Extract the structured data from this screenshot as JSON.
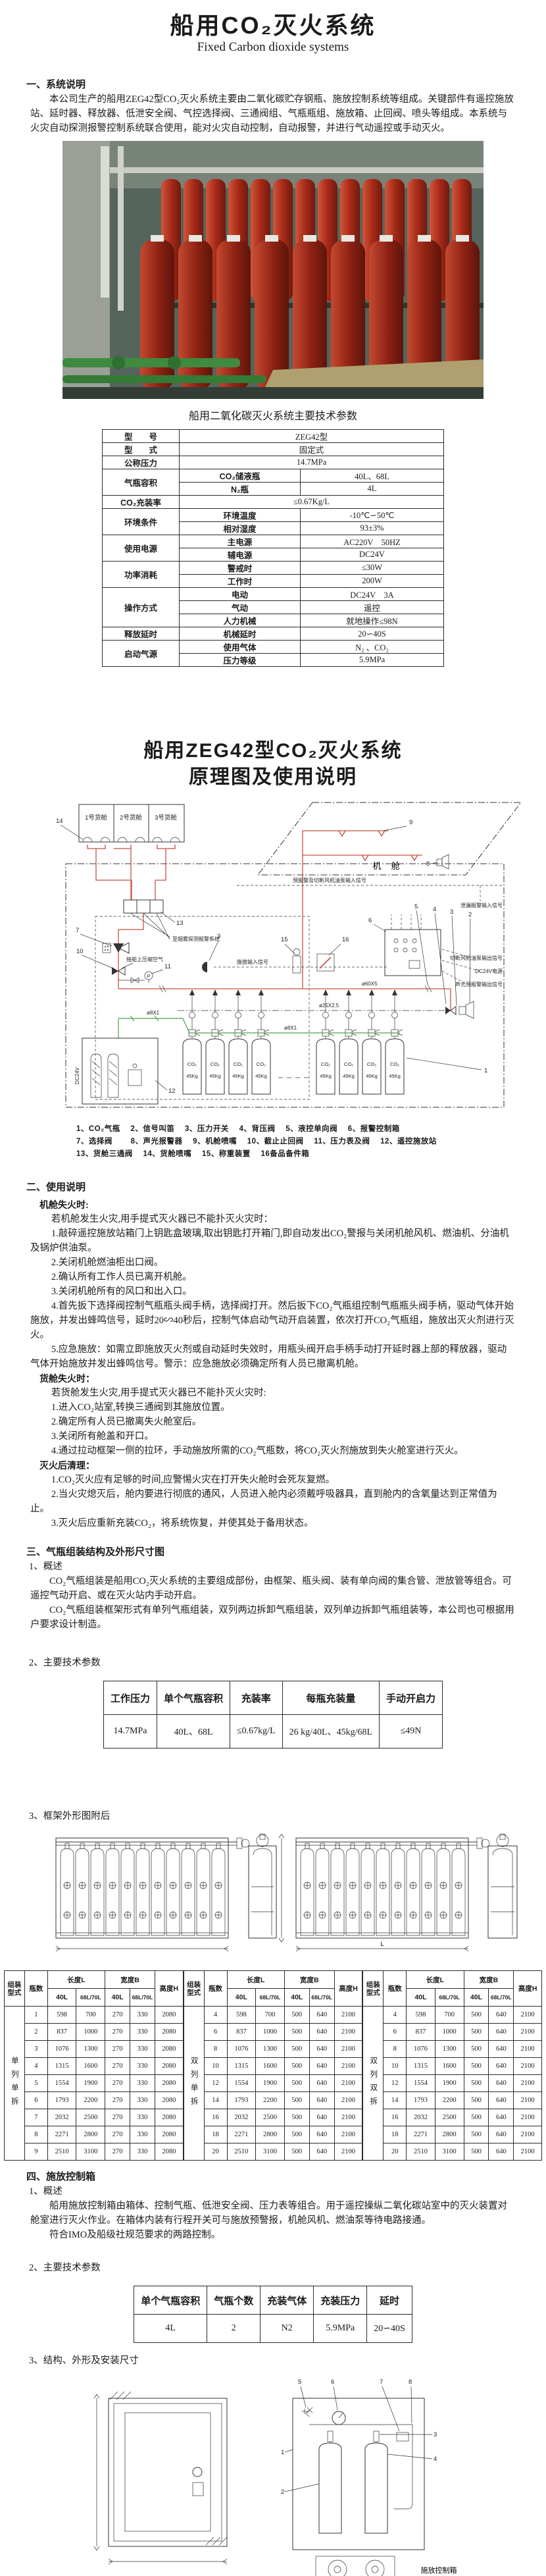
{
  "doc": {
    "title": "船用CO₂灭火系统",
    "subtitle": "Fixed Carbon dioxide systems"
  },
  "colors": {
    "diagram_red": "#c45242",
    "diagram_green": "#4f9e4f",
    "photo_red": "#b5301f"
  },
  "s1": {
    "h": "一、系统说明",
    "p": "本公司生产的船用ZEG42型CO₂灭火系统主要由二氧化碳贮存钢瓶、施放控制系统等组成。关键部件有遥控施放站、延时器、释放器、低泄安全阀、气控选择阀、三通阀组、气瓶瓶组、施放箱、止回阀、喷头等组成。本系统与火灾自动探测报警控制系统联合使用，能对火灾自动控制，自动报警，并进行气动遥控或手动灭火。"
  },
  "spec": {
    "caption": "船用二氧化碳灭火系统主要技术参数",
    "model_l": "型　　号",
    "model_v": "ZEG42型",
    "type_l": "型　　式",
    "type_v": "固定式",
    "press_l": "公称压力",
    "press_v": "14.7MPa",
    "vol_l": "气瓶容积",
    "vol_s1": "CO₂储液瓶",
    "vol_v1": "40L、68L",
    "vol_s2": "N₂瓶",
    "vol_v2": "4L",
    "fill_l": "CO₂充装率",
    "fill_v": "≤0.67Kg/L",
    "env_l": "环境条件",
    "env_s1": "环境温度",
    "env_v1": "-10℃∽50℃",
    "env_s2": "相对湿度",
    "env_v2": "93±3%",
    "pow_l": "使用电源",
    "pow_s1": "主电源",
    "pow_v1": "AC220V　50HZ",
    "pow_s2": "辅电源",
    "pow_v2": "DC24V",
    "cons_l": "功率消耗",
    "cons_s1": "警戒时",
    "cons_v1": "≤30W",
    "cons_s2": "工作时",
    "cons_v2": "200W",
    "op_l": "操作方式",
    "op_s1": "电动",
    "op_v1": "DC24V　3A",
    "op_s2": "气动",
    "op_v2": "遥控",
    "op_s3": "人力机械",
    "op_v3": "就地操作≤98N",
    "delay_l": "释放延时",
    "delay_s": "机械延时",
    "delay_v": "20∽40S",
    "gas_l": "启动气源",
    "gas_s1": "使用气体",
    "gas_v1": "N₂ 、CO₂",
    "gas_s2": "压力等级",
    "gas_v2": "5.9MPa"
  },
  "t2": {
    "l1": "船用ZEG42型CO₂灭火系统",
    "l2": "原理图及使用说明"
  },
  "dia": {
    "hold1": "1号货舱",
    "hold2": "2号货舱",
    "hold3": "3号货舱",
    "engine": "机 舱",
    "c1": "1",
    "c2": "2",
    "c3": "3",
    "c4": "4",
    "c5": "5",
    "c6": "6",
    "c7": "7",
    "c8": "8",
    "c9": "9",
    "c10": "10",
    "c11": "11",
    "c12": "12",
    "c13": "13",
    "c14": "14",
    "c15": "15",
    "c16": "16",
    "sig_pre": "预报警及切断风机油泵输入信号",
    "sig_rel": "施放输入信号",
    "sig_cut": "切断风机油泵输出信号",
    "sig_dc": "DC24V电源",
    "sig_av": "声光预报警输出信号",
    "sig_leak": "泄漏报警输入信号",
    "smoke": "至烟雾探测报警系统",
    "air": "接船上压缩空气",
    "p60": "ø60X5",
    "p25": "ø25X2.5",
    "p8a": "ø8X1",
    "p8b": "ø8X1",
    "dc": "DC24V",
    "cyl_t": "CO₂",
    "cyl_w": "45Kg",
    "p": "P"
  },
  "leg": {
    "l1": "1、CO₂气瓶　 2、信号叫笛　 3、压力开关　 4、背压阀　 5、液控单向阀　 6、报警控制箱",
    "l2": "7、选择阀　　 8、声光报警器　 9、机舱喷嘴　 10、截止止回阀　 11、压力表及阀　 12、遥控施放站",
    "l3": "13、货舱三通阀　 14、货舱喷嘴　 15、称重装置　 16备品备件箱"
  },
  "s2": {
    "h": "二、使用说明",
    "paras": [
      {
        "t": "机舱失火时:"
      },
      {
        "t": "若机舱发生火灾,用手提式灭火器已不能扑灭火灾时："
      },
      {
        "t": "1.敲碎遥控施放站箱门上钥匙盒玻璃,取出钥匙打开箱门,即自动发出CO₂警报与关闭机舱风机、燃油机、分油机及锅炉供油泵。"
      },
      {
        "t": "2.关闭机舱燃油柜出口阀。"
      },
      {
        "t": "2.确认所有工作人员已离开机舱。"
      },
      {
        "t": "3.关闭机舱所有的风口和出入口。"
      },
      {
        "t": "4.首先扳下选择阀控制气瓶瓶头阀手柄，选择阀打开。然后扳下CO₂气瓶组控制气瓶瓶头阀手柄，驱动气体开始施放，并发出蜂鸣信号，延时20∽40秒后，控制气体启动气动开启装置，依次打开CO₂气瓶组，施放出灭火剂进行灭火。"
      },
      {
        "t": "5.应急施放：如需立即施放灭火剂或自动延时失效时，用瓶头阀开启手柄手动打开延时器上部的释放器，驱动气体开始施放并发出蜂鸣信号。警示：应急施放必须确定所有人员已撤离机舱。"
      },
      {
        "t": "货舱失火时："
      },
      {
        "t": "若货舱发生火灾,用手提式灭火器已不能扑灭火灾时:"
      },
      {
        "t": "1.进入CO₂站室,转换三通阀到其施放位置。"
      },
      {
        "t": "2.确定所有人员已撤离失火舱室后。"
      },
      {
        "t": "3.关闭所有舱盖和开口。"
      },
      {
        "t": "4.通过拉动框架一侧的拉环，手动施放所需的CO₂气瓶数，将CO₂灭火剂施放到失火舱室进行灭火。"
      },
      {
        "t": "灭火后清理："
      },
      {
        "t": "1.CO₂灭火应有足够的时间,应警惕火灾在打开失火舱时会死灰复燃。"
      },
      {
        "t": "2.当火灾熄灭后，舱内要进行彻底的通风，人员进入舱内必须戴呼吸器具，直到舱内的含氧量达到正常值为止。"
      },
      {
        "t": "3.灭火后应重新充装CO₂，将系统恢复，并使其处于备用状态。"
      }
    ]
  },
  "s3": {
    "h": "三、气瓶组装结构及外形尺寸图",
    "h1": "1、概述",
    "p1": "CO₂气瓶组装是船用CO₂灭火系统的主要组成部份，由框架、瓶头阀、装有单向阀的集合管、泄放管等组合。可遥控气动开启、或在灭火站内手动开启。",
    "p2": "CO₂气瓶组装框架形式有单列气瓶组装，双列两边拆卸气瓶组装，双列单边拆卸气瓶组装等，本公司也可根据用户要求设计制造。",
    "h2": "2、主要技术参数",
    "h3": "3、框架外形图附后"
  },
  "rack_table": {
    "headers": [
      "工作压力",
      "单个气瓶容积",
      "充装率",
      "每瓶充装量",
      "手动开启力"
    ],
    "rows": [
      [
        "14.7MPa",
        "40L、68L",
        "≤0.67kg/L",
        "26 kg/40L、45kg/68L",
        "≤49N"
      ]
    ]
  },
  "rack": {
    "dim": "L"
  },
  "dim": {
    "header": {
      "type": "组装型式",
      "count": "瓶数",
      "length": "长度L",
      "width": "宽度B",
      "height": "高度H",
      "c40": "40L",
      "c68": "68L/70L"
    },
    "groups": [
      {
        "type": "单列单拆",
        "rows": [
          [
            1,
            598,
            700,
            270,
            330,
            2080
          ],
          [
            2,
            837,
            1000,
            270,
            330,
            2080
          ],
          [
            3,
            1076,
            1300,
            270,
            330,
            2080
          ],
          [
            4,
            1315,
            1600,
            270,
            330,
            2080
          ],
          [
            5,
            1554,
            1900,
            270,
            330,
            2080
          ],
          [
            6,
            1793,
            2200,
            270,
            330,
            2080
          ],
          [
            7,
            2032,
            2500,
            270,
            330,
            2080
          ],
          [
            8,
            2271,
            2800,
            270,
            330,
            2080
          ],
          [
            9,
            2510,
            3100,
            270,
            330,
            2080
          ]
        ]
      },
      {
        "type": "双列单拆",
        "rows": [
          [
            4,
            598,
            700,
            500,
            640,
            2100
          ],
          [
            6,
            837,
            1000,
            500,
            640,
            2100
          ],
          [
            8,
            1076,
            1300,
            500,
            640,
            2100
          ],
          [
            10,
            1315,
            1600,
            500,
            640,
            2100
          ],
          [
            12,
            1554,
            1900,
            500,
            640,
            2100
          ],
          [
            14,
            1793,
            2200,
            500,
            640,
            2100
          ],
          [
            16,
            2032,
            2500,
            500,
            640,
            2100
          ],
          [
            18,
            2271,
            2800,
            500,
            640,
            2100
          ],
          [
            20,
            2510,
            3100,
            500,
            640,
            2100
          ]
        ]
      },
      {
        "type": "双列双拆",
        "rows": [
          [
            4,
            598,
            700,
            500,
            640,
            2100
          ],
          [
            6,
            837,
            1000,
            500,
            640,
            2100
          ],
          [
            8,
            1076,
            1300,
            500,
            640,
            2100
          ],
          [
            10,
            1315,
            1600,
            500,
            640,
            2100
          ],
          [
            12,
            1554,
            1900,
            500,
            640,
            2100
          ],
          [
            14,
            1793,
            2200,
            500,
            640,
            2100
          ],
          [
            16,
            2032,
            2500,
            500,
            640,
            2100
          ],
          [
            18,
            2271,
            2800,
            500,
            640,
            2100
          ],
          [
            20,
            2510,
            3100,
            500,
            640,
            2100
          ]
        ]
      }
    ]
  },
  "s4": {
    "h": "四、施放控制箱",
    "h1": "1、概述",
    "p1": "船用施放控制箱由箱体、控制气瓶、低泄安全阀、压力表等组合。用于遥控操纵二氧化碳站室中的灭火装置对舱室进行灭火作业。在箱体内装有行程开关可与施放预警报，机舱风机、燃油泵等待电路接通。",
    "p2": "符合IMO及船级社规范要求的两路控制。",
    "h2": "2、主要技术参数",
    "h3": "3、结构、外形及安装尺寸"
  },
  "ctrl_table": {
    "headers": [
      "单个气瓶容积",
      "气瓶个数",
      "充装气体",
      "充装压力",
      "延时"
    ],
    "rows": [
      [
        "4L",
        "2",
        "N2",
        "5.9MPa",
        "20∽40S"
      ]
    ]
  },
  "box": {
    "legend": "1箱体　2控制气瓶　3瓶头阀　4放气阀　5低泄安全阀　6压力表　7行程开关　8铜管",
    "caption": "施放控制箱",
    "n1": "1",
    "n2": "2",
    "n3": "3",
    "n4": "4",
    "n5": "5",
    "n6": "6",
    "n7": "7",
    "n8": "8"
  }
}
